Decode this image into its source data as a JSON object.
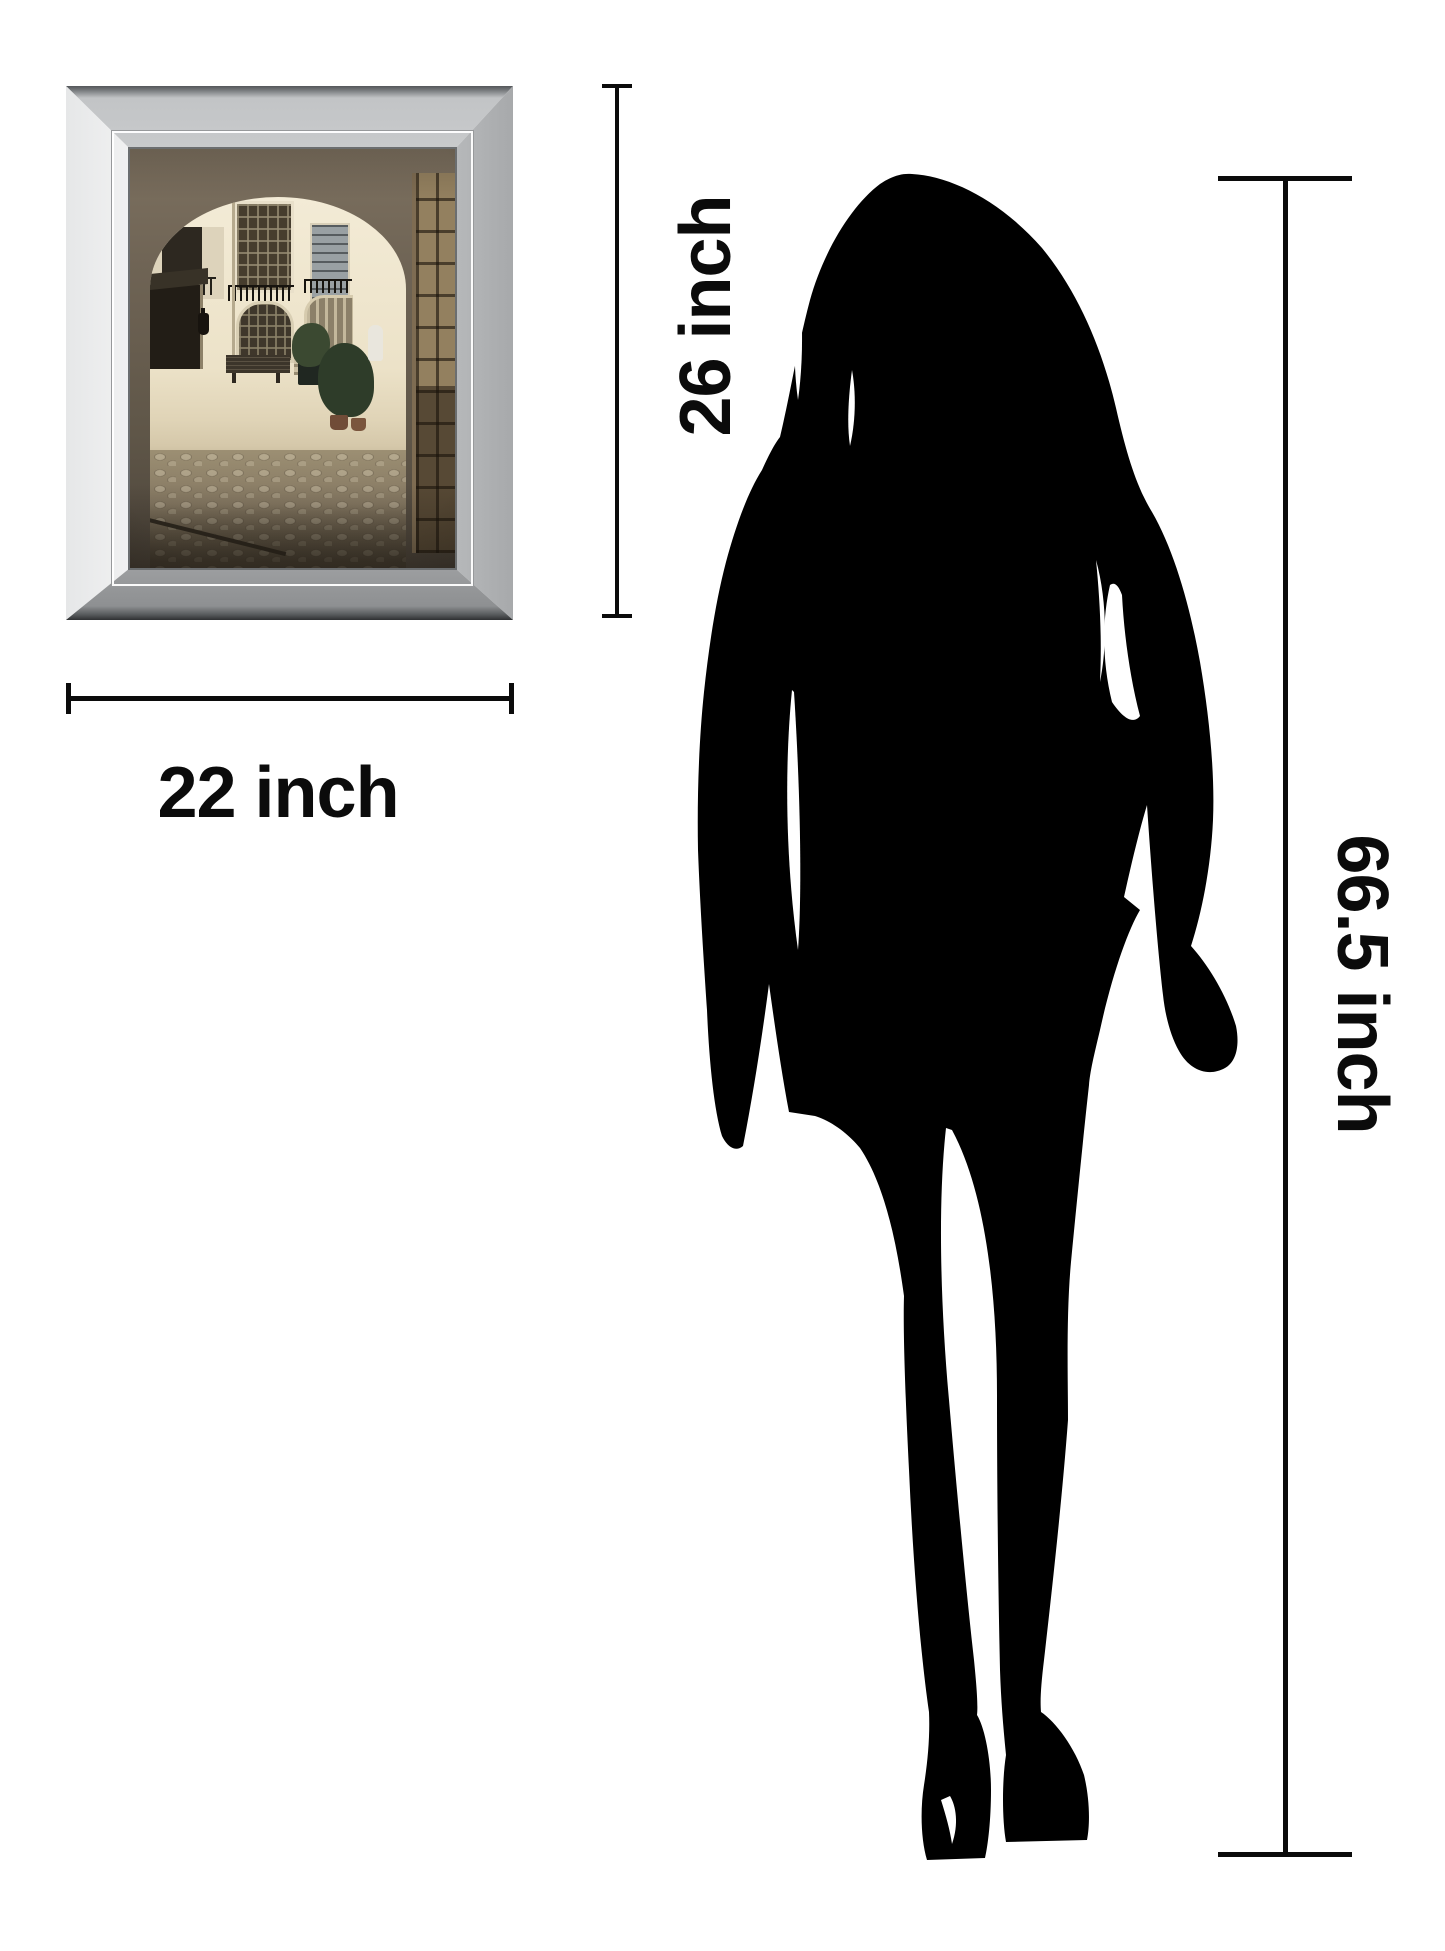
{
  "page": {
    "background_color": "#ffffff",
    "kind": "product size comparison diagram"
  },
  "labels": {
    "frame_width": "22 inch",
    "frame_height": "26 inch",
    "person_height": "66.5 inch"
  },
  "dimension_lines": {
    "color": "#0b0b0b",
    "width_line": {
      "label": "22 inch",
      "orientation": "horizontal"
    },
    "height_line": {
      "label": "26 inch",
      "orientation": "vertical"
    },
    "person_line": {
      "label": "66.5 inch",
      "orientation": "vertical"
    }
  },
  "artwork": {
    "type": "mirror-framed-wall-art",
    "scene_icon": "paris-courtyard-archway-photo",
    "colors": {
      "frame_silver": "#c9cbcd",
      "frame_white": "#f7f7f8",
      "frame_edge_dark": "#2e3032",
      "arch_wall": "#6e6354",
      "facade_cream": "#ece2c8",
      "cobblestone": "#8d8068",
      "door_wood": "#6a5942",
      "plants_green": "#2e3c29"
    }
  },
  "silhouette": {
    "icon": "woman-silhouette",
    "color": "#000000"
  }
}
